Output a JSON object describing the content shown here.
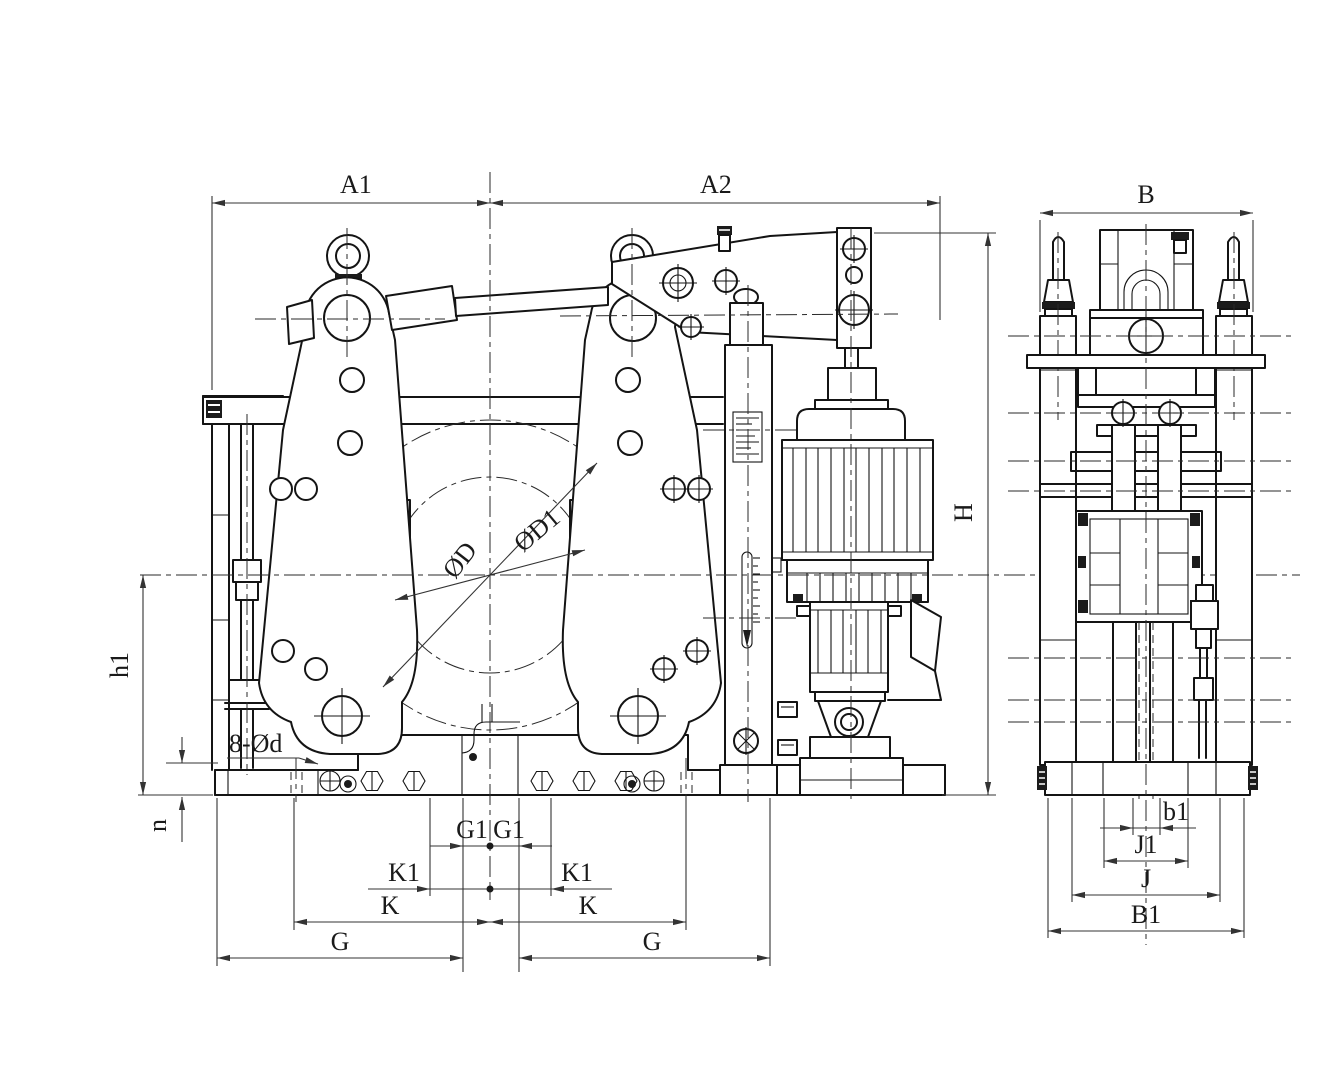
{
  "colors": {
    "background": "#ffffff",
    "line": "#141414",
    "dim_line": "#333333"
  },
  "labels": {
    "A1": "A1",
    "A2": "A2",
    "B": "B",
    "H": "H",
    "h1": "h1",
    "n": "n",
    "mount_holes": "8-Ød",
    "drum_diameter": "ØD",
    "drum_outer_diameter": "ØD1",
    "G1_left": "G1",
    "G1_right": "G1",
    "K1_left": "K1",
    "K1_right": "K1",
    "K_left": "K",
    "K_right": "K",
    "G_left": "G",
    "G_right": "G",
    "b1": "b1",
    "J1": "J1",
    "J": "J",
    "B1": "B1"
  }
}
